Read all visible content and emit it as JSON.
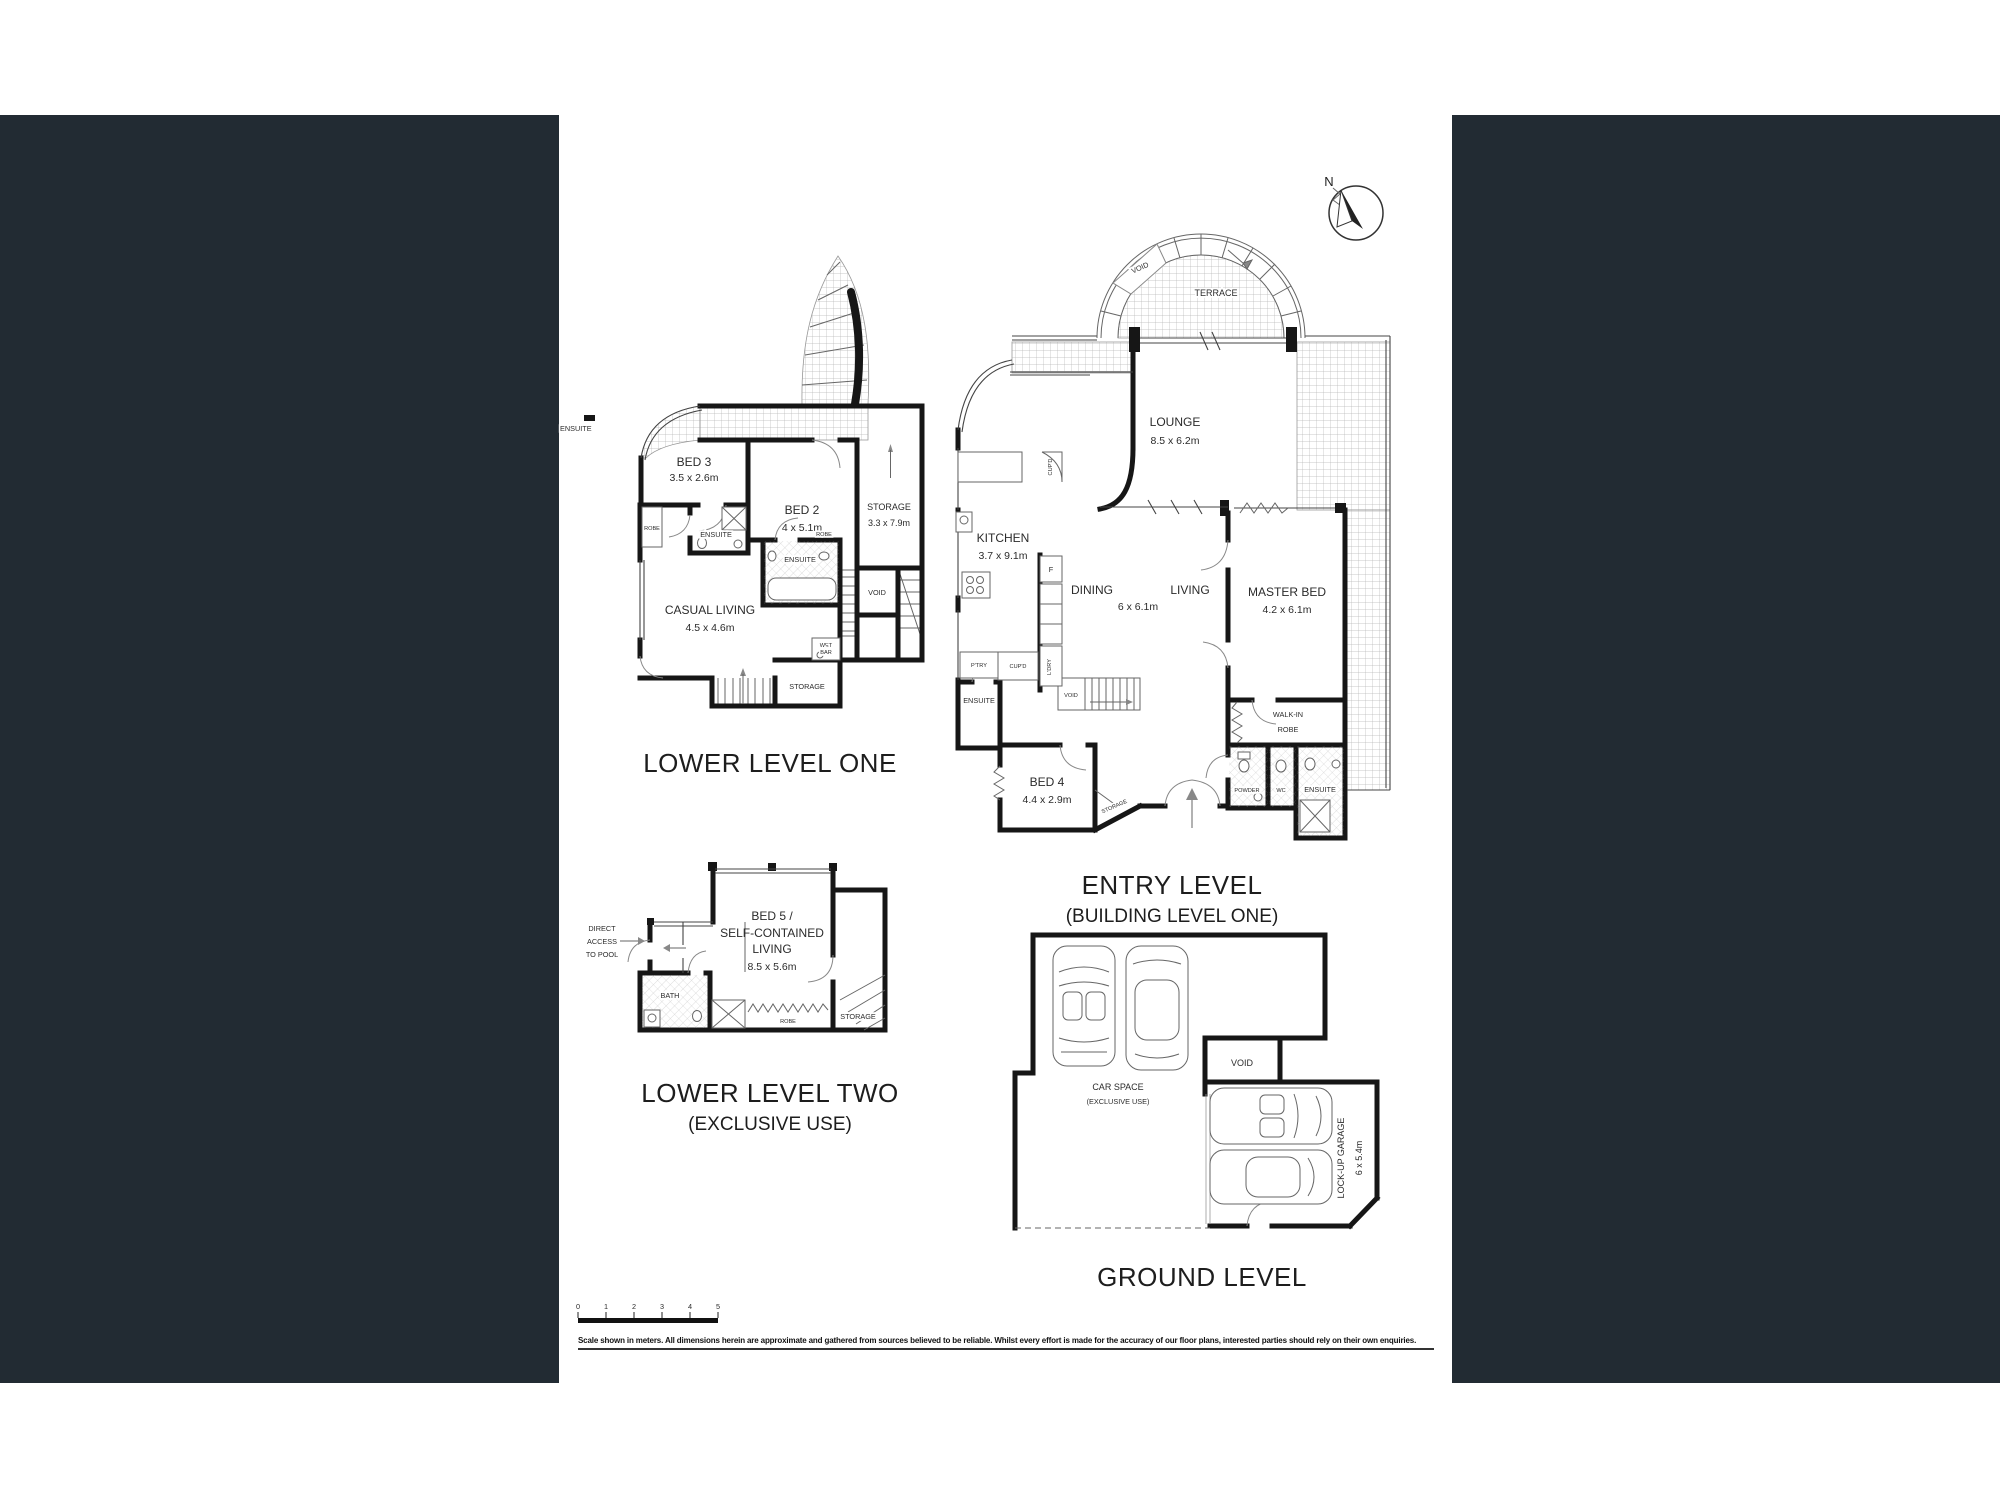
{
  "page": {
    "background": "#ffffff",
    "panel_color": "#222b33"
  },
  "compass": {
    "n": "N"
  },
  "p1": {
    "title": "LOWER LEVEL ONE",
    "bed2": "BED 2",
    "bed2_d": "4 x 5.1m",
    "bed3": "BED 3",
    "bed3_d": "3.5 x 2.6m",
    "storage": "STORAGE",
    "storage_d": "3.3 x 7.9m",
    "casual": "CASUAL LIVING",
    "casual_d": "4.5 x 4.6m",
    "ensuite_a": "ENSUITE",
    "ensuite_b": "ENSUITE",
    "ensuite_edge": "ENSUITE",
    "robe_a": "ROBE",
    "robe_b": "ROBE",
    "void": "VOID",
    "wet": "WET",
    "bar": "BAR",
    "storage2": "STORAGE"
  },
  "p2": {
    "title": "ENTRY LEVEL",
    "subtitle": "(BUILDING LEVEL ONE)",
    "terrace": "TERRACE",
    "void_top": "VOID",
    "lounge": "LOUNGE",
    "lounge_d": "8.5 x 6.2m",
    "kitchen": "KITCHEN",
    "kitchen_d": "3.7 x 9.1m",
    "dining": "DINING",
    "living": "LIVING",
    "dl_d": "6 x 6.1m",
    "master": "MASTER BED",
    "master_d": "4.2 x 6.1m",
    "bed4": "BED 4",
    "bed4_d": "4.4 x 2.9m",
    "walkin1": "WALK-IN",
    "walkin2": "ROBE",
    "ensuite_l": "ENSUITE",
    "powder": "POWDER",
    "wc": "WC",
    "ensuite_r": "ENSUITE",
    "void_mid": "VOID",
    "storage": "STORAGE",
    "f": "F",
    "cupd1": "CUP'D",
    "ptry": "P'TRY",
    "cupd2": "CUP'D",
    "ldry": "L'DRY"
  },
  "p3": {
    "title": "LOWER LEVEL TWO",
    "subtitle": "(EXCLUSIVE USE)",
    "da1": "DIRECT",
    "da2": "ACCESS",
    "da3": "TO POOL",
    "bed5_1": "BED 5 /",
    "bed5_2": "SELF-CONTAINED",
    "bed5_3": "LIVING",
    "bed5_d": "8.5 x 5.6m",
    "bath": "BATH",
    "robe": "ROBE",
    "storage": "STORAGE"
  },
  "p4": {
    "title": "GROUND LEVEL",
    "car1": "CAR SPACE",
    "car2": "(EXCLUSIVE  USE)",
    "void": "VOID",
    "garage": "LOCK-UP GARAGE",
    "garage_d": "6 x 5.4m"
  },
  "scalebar": {
    "t0": "0",
    "t1": "1",
    "t2": "2",
    "t3": "3",
    "t4": "4",
    "t5": "5"
  },
  "disclaimer": "Scale shown in meters. All dimensions herein are approximate and gathered from sources believed to be reliable. Whilst every effort is made for the accuracy of our floor plans, interested parties should rely on their own enquiries."
}
